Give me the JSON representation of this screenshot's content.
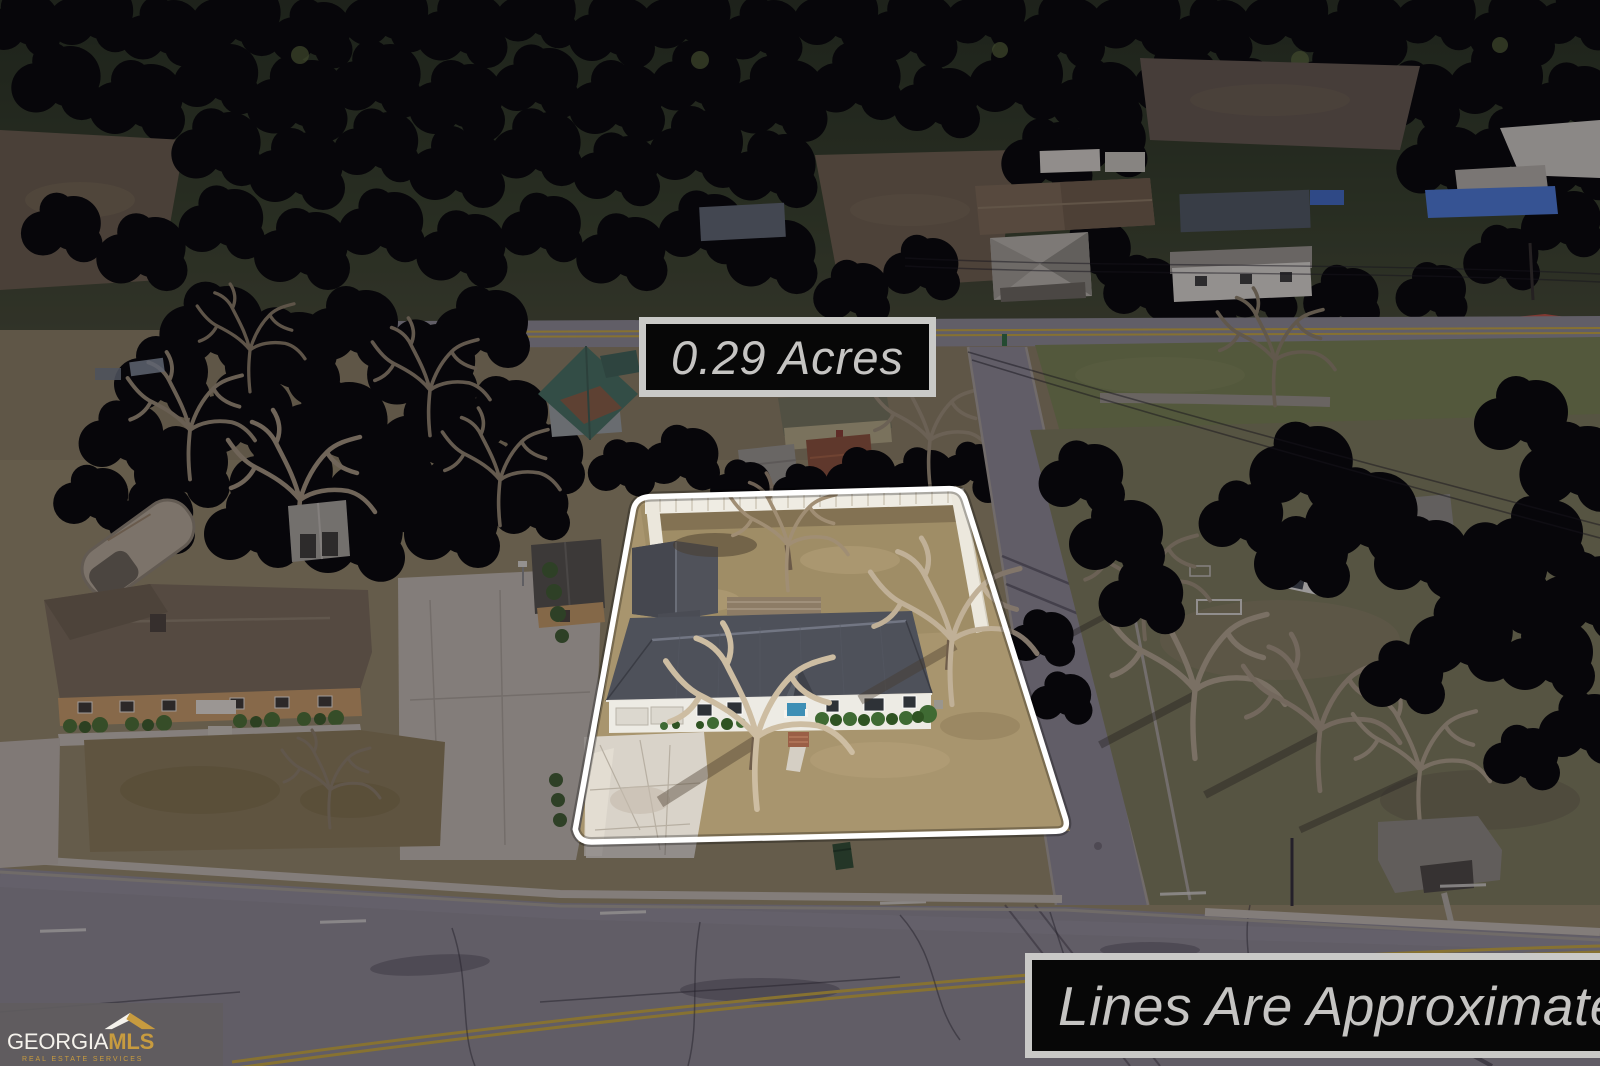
{
  "overlays": {
    "acreage_label": "0.29 Acres",
    "disclaimer_label": "Lines Are Approximate"
  },
  "logo": {
    "brand_primary": "GEORGIA",
    "brand_secondary": "MLS",
    "tagline": "REAL ESTATE SERVICES"
  },
  "colors": {
    "boundary_line": "#ffffff",
    "label_background": "#070707",
    "label_border": "#c9c9c7",
    "label_text": "#c5c4c2",
    "logo_background": "#605c5f",
    "logo_white": "#f5f2ec",
    "logo_gold": "#c79b3f"
  }
}
